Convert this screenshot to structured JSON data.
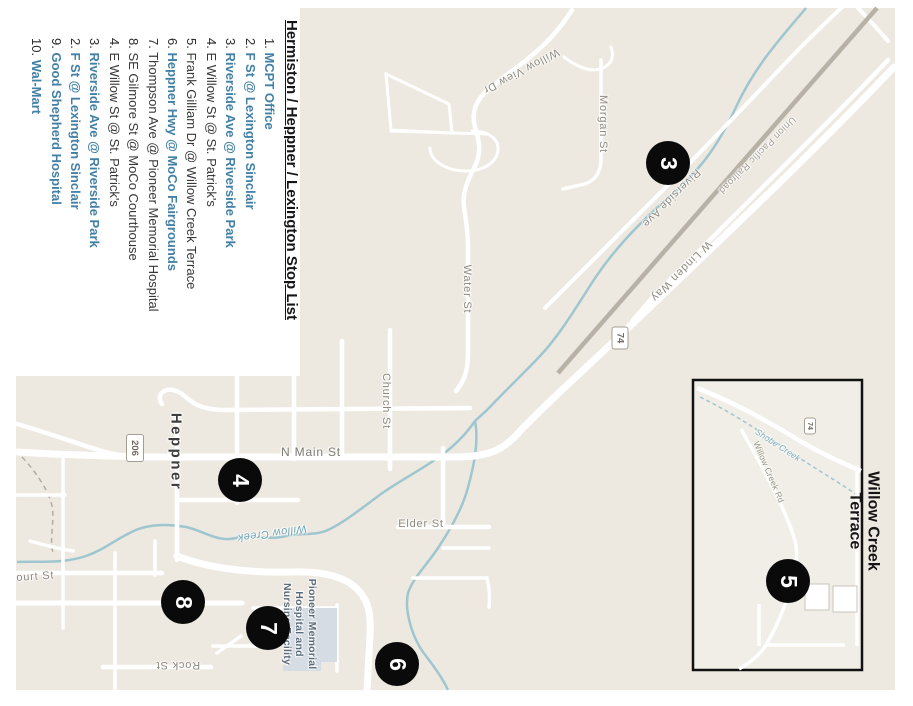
{
  "title": "Hermiston / Heppner / Lexington Stop List",
  "stops": [
    {
      "num": "1",
      "name": "MCPT Office",
      "accent": true
    },
    {
      "num": "2",
      "name": "F St @ Lexington Sinclair",
      "accent": true
    },
    {
      "num": "3",
      "name": "Riverside Ave @ Riverside Park",
      "accent": true
    },
    {
      "num": "4",
      "name": "E Willow St @ St. Patrick's",
      "accent": false
    },
    {
      "num": "5",
      "name": "Frank Gilliam Dr @ Willow Creek Terrace",
      "accent": false
    },
    {
      "num": "6",
      "name": "Heppner Hwy @ MoCo Fairgrounds",
      "accent": true
    },
    {
      "num": "7",
      "name": "Thompson Ave @ Pioneer Memorial Hospital",
      "accent": false
    },
    {
      "num": "8",
      "name": "SE Gilmore St @ MoCo Courthouse",
      "accent": false
    },
    {
      "num": "4",
      "name": "E Willow St @ St. Patrick's",
      "accent": false
    },
    {
      "num": "3",
      "name": "Riverside Ave @ Riverside Park",
      "accent": true
    },
    {
      "num": "2",
      "name": "F St @ Lexington Sinclair",
      "accent": true
    },
    {
      "num": "9",
      "name": "Good Shepherd Hospital",
      "accent": true
    },
    {
      "num": "10",
      "name": "Wal-Mart",
      "accent": true
    }
  ],
  "colors": {
    "accent_blue": "#4280a6",
    "map_background": "#ede9e1",
    "road": "#ffffff",
    "creek": "#9fc6cf",
    "railroad": "#b8b1a6",
    "marker": "#0a0a0a",
    "hospital_building": "#d6dce3"
  },
  "map": {
    "city_label": "Heppner",
    "labels": {
      "n_main_st": "N Main St",
      "elder_st": "Elder St",
      "court_st": "Court St",
      "rock_st": "Rock St",
      "church_st": "Church St",
      "water_st": "Water St",
      "morgan_st": "Morgan St",
      "willow_view_dr": "Willow View Dr",
      "riverside_ave": "Riverside Ave",
      "w_linden_way": "W Linden Way",
      "railroad": "Union Pacific Railroad",
      "willow_creek": "Willow Creek",
      "willow_creek_rd": "Willow Creek Rd",
      "shobe_creek": "Shobe Creek"
    },
    "shields": {
      "route_206": "206",
      "route_74": "74",
      "inset_74": "74"
    },
    "markers": [
      "3",
      "4",
      "5",
      "6",
      "7",
      "8"
    ],
    "hospital_label_lines": [
      "Pioneer Memorial",
      "Hospital and",
      "Nursing Facility"
    ],
    "inset_title_lines": [
      "Willow Creek",
      "Terrace"
    ]
  }
}
